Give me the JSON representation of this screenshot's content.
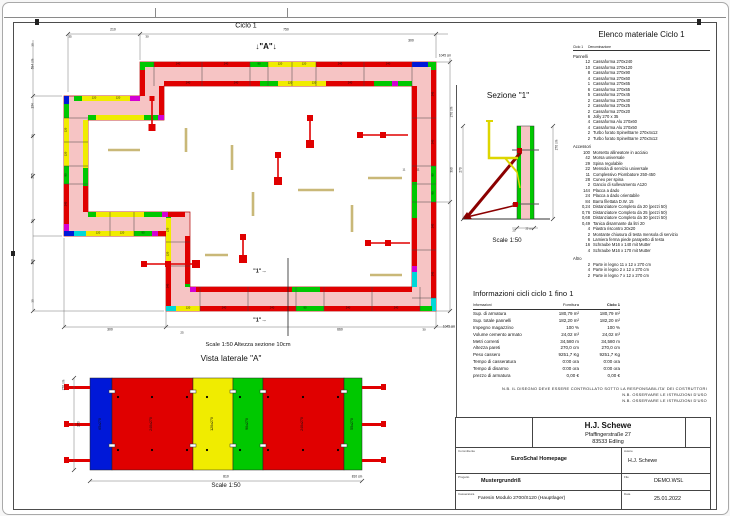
{
  "plan": {
    "labels": [
      {
        "t": "Ciclo 1",
        "x": 246,
        "y": 26,
        "s": 7
      },
      {
        "t": "↓\"A\"↓",
        "x": 266,
        "y": 47,
        "s": 8,
        "b": 1
      },
      {
        "t": "210",
        "x": 113,
        "y": 30,
        "s": 3.4
      },
      {
        "t": "35",
        "x": 70,
        "y": 37,
        "s": 3
      },
      {
        "t": "30",
        "x": 147,
        "y": 37,
        "s": 3
      },
      {
        "t": "750",
        "x": 286,
        "y": 30,
        "s": 3.4
      },
      {
        "t": "300",
        "x": 411,
        "y": 41,
        "s": 3.4
      },
      {
        "t": "1045 cm",
        "x": 445,
        "y": 56,
        "s": 3.2
      },
      {
        "t": "30",
        "x": 33,
        "y": 45,
        "s": 3,
        "r": 1
      },
      {
        "t": "694 cm",
        "x": 33,
        "y": 64,
        "s": 3.2,
        "r": 1
      },
      {
        "t": "134",
        "x": 33,
        "y": 106,
        "s": 3.2,
        "r": 1
      },
      {
        "t": "30",
        "x": 33,
        "y": 136,
        "s": 3,
        "r": 1
      },
      {
        "t": "255",
        "x": 33,
        "y": 176,
        "s": 3.2,
        "r": 1
      },
      {
        "t": "20",
        "x": 33,
        "y": 221,
        "s": 3,
        "r": 1
      },
      {
        "t": "190",
        "x": 33,
        "y": 262,
        "s": 3.2,
        "r": 1
      },
      {
        "t": "30",
        "x": 33,
        "y": 301,
        "s": 3,
        "r": 1
      },
      {
        "t": "300",
        "x": 110,
        "y": 330,
        "s": 3.4
      },
      {
        "t": "25",
        "x": 182,
        "y": 333,
        "s": 3
      },
      {
        "t": "660",
        "x": 340,
        "y": 330,
        "s": 3.4
      },
      {
        "t": "30",
        "x": 424,
        "y": 330,
        "s": 3
      },
      {
        "t": "1045 cm",
        "x": 449,
        "y": 327,
        "s": 3.2
      },
      {
        "t": "270 cm",
        "x": 452,
        "y": 112,
        "s": 3.2,
        "r": 1
      },
      {
        "t": "390",
        "x": 452,
        "y": 170,
        "s": 3.2,
        "r": 1
      },
      {
        "t": "11",
        "x": 404,
        "y": 170,
        "s": 2.8
      },
      {
        "t": "11",
        "x": 418,
        "y": 170,
        "s": 2.8
      },
      {
        "t": "\"1\"→",
        "x": 260,
        "y": 272,
        "s": 5.5,
        "b": 1
      },
      {
        "t": "\"1\"→",
        "x": 260,
        "y": 321,
        "s": 5.5,
        "b": 1
      },
      {
        "t": "Scale 1:50   Altezza sezione 10cm",
        "x": 248,
        "y": 346,
        "s": 5.8
      },
      {
        "t": "240",
        "x": 178,
        "y": 64.5,
        "s": 2.7
      },
      {
        "t": "240",
        "x": 226,
        "y": 64.5,
        "s": 2.7
      },
      {
        "t": "90",
        "x": 259,
        "y": 64.5,
        "s": 2.7
      },
      {
        "t": "120",
        "x": 280,
        "y": 64.5,
        "s": 2.7
      },
      {
        "t": "120",
        "x": 304,
        "y": 64.5,
        "s": 2.7
      },
      {
        "t": "240",
        "x": 340,
        "y": 64.5,
        "s": 2.7
      },
      {
        "t": "240",
        "x": 388,
        "y": 64.5,
        "s": 2.7
      },
      {
        "t": "240",
        "x": 188,
        "y": 83.5,
        "s": 2.7
      },
      {
        "t": "240",
        "x": 236,
        "y": 83.5,
        "s": 2.7
      },
      {
        "t": "120",
        "x": 290,
        "y": 83.5,
        "s": 2.7
      },
      {
        "t": "120",
        "x": 314,
        "y": 83.5,
        "s": 2.7
      },
      {
        "t": "240",
        "x": 350,
        "y": 83.5,
        "s": 2.7
      },
      {
        "t": "240",
        "x": 433.5,
        "y": 94,
        "s": 2.7,
        "r": 1
      },
      {
        "t": "240",
        "x": 433.5,
        "y": 142,
        "s": 2.7,
        "r": 1
      },
      {
        "t": "90",
        "x": 433.5,
        "y": 175,
        "s": 2.7,
        "r": 1
      },
      {
        "t": "90",
        "x": 433.5,
        "y": 193,
        "s": 2.7,
        "r": 1
      },
      {
        "t": "240",
        "x": 433.5,
        "y": 226,
        "s": 2.7,
        "r": 1
      },
      {
        "t": "240",
        "x": 433.5,
        "y": 274,
        "s": 2.7,
        "r": 1
      },
      {
        "t": "120",
        "x": 188,
        "y": 308.5,
        "s": 2.7
      },
      {
        "t": "240",
        "x": 224,
        "y": 308.5,
        "s": 2.7
      },
      {
        "t": "240",
        "x": 272,
        "y": 308.5,
        "s": 2.7
      },
      {
        "t": "90",
        "x": 305,
        "y": 308.5,
        "s": 2.7
      },
      {
        "t": "240",
        "x": 348,
        "y": 308.5,
        "s": 2.7
      },
      {
        "t": "240",
        "x": 396,
        "y": 308.5,
        "s": 2.7
      },
      {
        "t": "120",
        "x": 66.5,
        "y": 130,
        "s": 2.7,
        "r": 1
      },
      {
        "t": "120",
        "x": 66.5,
        "y": 154,
        "s": 2.7,
        "r": 1
      },
      {
        "t": "90",
        "x": 66.5,
        "y": 175,
        "s": 2.7,
        "r": 1
      },
      {
        "t": "240",
        "x": 66.5,
        "y": 204,
        "s": 2.7,
        "r": 1
      },
      {
        "t": "120",
        "x": 98,
        "y": 233.5,
        "s": 2.7
      },
      {
        "t": "120",
        "x": 122,
        "y": 233.5,
        "s": 2.7
      },
      {
        "t": "90",
        "x": 143,
        "y": 233.5,
        "s": 2.7
      },
      {
        "t": "120",
        "x": 168.5,
        "y": 230,
        "s": 2.7,
        "r": 1
      },
      {
        "t": "120",
        "x": 168.5,
        "y": 254,
        "s": 2.7,
        "r": 1
      },
      {
        "t": "240",
        "x": 168.5,
        "y": 286,
        "s": 2.7,
        "r": 1
      },
      {
        "t": "120",
        "x": 94,
        "y": 98.5,
        "s": 2.7
      },
      {
        "t": "120",
        "x": 118,
        "y": 98.5,
        "s": 2.7
      }
    ]
  },
  "side_view": {
    "labels": [
      {
        "t": "Vista laterale \"A\"",
        "x": 231,
        "y": 359,
        "s": 8.2
      },
      {
        "t": "65x270",
        "x": 101,
        "y": 424,
        "s": 3.6,
        "r": 1
      },
      {
        "t": "240x270",
        "x": 152,
        "y": 424,
        "s": 3.6,
        "r": 1
      },
      {
        "t": "120x270",
        "x": 213,
        "y": 424,
        "s": 3.6,
        "r": 1
      },
      {
        "t": "90x270",
        "x": 248,
        "y": 424,
        "s": 3.6,
        "r": 1
      },
      {
        "t": "240x270",
        "x": 303,
        "y": 424,
        "s": 3.6,
        "r": 1
      },
      {
        "t": "55x270",
        "x": 353,
        "y": 424,
        "s": 3.6,
        "r": 1
      },
      {
        "t": "270 cm",
        "x": 64,
        "y": 385,
        "s": 3.2,
        "r": 1
      },
      {
        "t": "270",
        "x": 79,
        "y": 424,
        "s": 3.4,
        "r": 1
      },
      {
        "t": "810",
        "x": 226,
        "y": 477,
        "s": 3.4
      },
      {
        "t": "810 cm",
        "x": 357,
        "y": 477,
        "s": 3.2
      },
      {
        "t": "Scale 1:50",
        "x": 226,
        "y": 486,
        "s": 6.2
      }
    ]
  },
  "sezione": {
    "labels": [
      {
        "t": "Sezione \"1\"",
        "x": 508,
        "y": 96,
        "s": 8.2
      },
      {
        "t": "270 cm",
        "x": 557,
        "y": 145,
        "s": 3.2,
        "r": 1
      },
      {
        "t": "270",
        "x": 461,
        "y": 170,
        "s": 3.2,
        "r": 1
      },
      {
        "t": "25",
        "x": 514,
        "y": 232,
        "s": 2.6
      },
      {
        "t": "25 cm",
        "x": 529,
        "y": 230,
        "s": 2.6
      },
      {
        "t": "Scale 1:50",
        "x": 507,
        "y": 241,
        "s": 6.2
      }
    ]
  },
  "material_list": {
    "title": "Elenco materiale  Ciclo 1",
    "cols": [
      "Ciclo 1",
      "Denominazione"
    ],
    "groups": [
      {
        "name": "Pannelli",
        "items": [
          {
            "qty": "12",
            "name": "Cassaforma 270x240"
          },
          {
            "qty": "10",
            "name": "Cassaforma 270x120"
          },
          {
            "qty": "8",
            "name": "Cassaforma 270x90"
          },
          {
            "qty": "4",
            "name": "Cassaforma 270x60"
          },
          {
            "qty": "1",
            "name": "Cassaforma 270x65"
          },
          {
            "qty": "6",
            "name": "Cassaforma 270x55"
          },
          {
            "qty": "5",
            "name": "Cassaforma 270x45"
          },
          {
            "qty": "2",
            "name": "Cassaforma 270x40"
          },
          {
            "qty": "2",
            "name": "Cassaforma 270x25"
          },
          {
            "qty": "2",
            "name": "Cassaforma 270x20"
          },
          {
            "qty": "6",
            "name": "Jolly 270 x 35"
          },
          {
            "qty": "4",
            "name": "Cassaforma Alu 270x60"
          },
          {
            "qty": "4",
            "name": "Cassaforma Alu 270x50"
          },
          {
            "qty": "2",
            "name": "Turbo forato Spine/Barre 270x4x12"
          },
          {
            "qty": "2",
            "name": "Turbo forato Spine/Barre 270x3x12"
          }
        ]
      },
      {
        "name": "Accessori",
        "items": [
          {
            "qty": "100",
            "name": "Morsetto allineatore in acciaio"
          },
          {
            "qty": "42",
            "name": "Morsa universale"
          },
          {
            "qty": "29",
            "name": "Spina regolabile"
          },
          {
            "qty": "22",
            "name": "Mensola di servizio universale"
          },
          {
            "qty": "11",
            "name": "Complessivo Piombatore 250-450"
          },
          {
            "qty": "28",
            "name": "Cuneo per spina"
          },
          {
            "qty": "2",
            "name": "Gancio di sollevamento A120"
          },
          {
            "qty": "144",
            "name": "Placca a dado"
          },
          {
            "qty": "24",
            "name": "Placca a dado orientabile"
          },
          {
            "qty": "84",
            "name": "Barra filettata D.W. 15"
          },
          {
            "qty": "0,24",
            "name": "Distanziatore Completo da 20 (pezzi 50)"
          },
          {
            "qty": "0,76",
            "name": "Distanziatore Completo da 25 (pezzi 50)"
          },
          {
            "qty": "0,68",
            "name": "Distanziatore Completo da 30 (pezzi 50)"
          },
          {
            "qty": "0,49",
            "name": "Tanica disarmante da litri 20"
          },
          {
            "qty": "4",
            "name": "Piastra riscontro 20x20"
          },
          {
            "qty": "2",
            "name": "Montante chiusura di testa mensola di servizio"
          },
          {
            "qty": "6",
            "name": "Lamiera ferma piede parapetto di testa"
          },
          {
            "qty": "16",
            "name": "Schraube M16 x 140 mit Mutter"
          },
          {
            "qty": "4",
            "name": "Schraube M16 x 170 mit Mutter"
          }
        ]
      },
      {
        "name": "Altro",
        "items": [
          {
            "qty": "2",
            "name": "Parte in legno 11 x 12 x 270 cm"
          },
          {
            "qty": "4",
            "name": "Parte in legno 2 x 12 x 270 cm"
          },
          {
            "qty": "2",
            "name": "Parte in legno 7 x 12 x 270 cm"
          }
        ]
      }
    ]
  },
  "info_table": {
    "title": "Informazioni cicli  ciclo 1 fino 1",
    "headers": [
      "Informazioni",
      "Fornitura",
      "Ciclo 1"
    ],
    "rows": [
      [
        "Sup. di armatura",
        "180,79 m²",
        "180,79 m²"
      ],
      [
        "Sup. totale pannelli",
        "182,20 m²",
        "182,20 m²"
      ],
      [
        "Impegno magazzino",
        "100 %",
        "100 %"
      ],
      [
        "Volume cemento armato",
        "24,02 m³",
        "24,02 m³"
      ],
      [
        "Metri correnti",
        "34,580 m",
        "34,580 m"
      ],
      [
        "Altezza pareti",
        "270,0 cm",
        "270,0 cm"
      ],
      [
        "Peso cassero",
        "9251,7 Kg",
        "9251,7 Kg"
      ],
      [
        "Tempo di casseratura",
        "0:00 ora",
        "0:00 ora"
      ],
      [
        "Tempo di disarmo",
        "0:00 ora",
        "0:00 ora"
      ],
      [
        "prezzo di armatura",
        "0,00 €",
        "0,00 €"
      ]
    ]
  },
  "notes": {
    "line1": "N.B. IL DISEGNO DEVE ESSERE CONTROLLATO SOTTO LA RESPONSABILITA' DEI COSTRUTTORI",
    "line2": "N.B. OSSERVARE LE ISTRUZIONI D'USO",
    "line3": "N.B. OSSERVARE LE ISTRUZIONI D'USO"
  },
  "title_block": {
    "company": "H.J. Schewe",
    "street": "Pfaffingerstraße 27",
    "city": "83533 Edling",
    "committente_label": "Committente",
    "committente": "EuroSchal Homepage",
    "autore_label": "Autore",
    "autore": "H.J. Schewe",
    "progetto_label": "Progetto",
    "progetto": "Mustergrundriß",
    "file_label": "File",
    "file": "DEMO.WSL",
    "casseratura_label": "Casseratura",
    "casseratura": "Faresin Modulo 2700/S120 (Hauptlager)",
    "data_label": "Data",
    "data": "25.01.2022"
  },
  "colors": {
    "panel_red": "#e00000",
    "panel_yellow": "#f0ec00",
    "panel_green": "#00c800",
    "panel_blue": "#0018d8",
    "panel_cyan": "#00d8d8",
    "panel_magenta": "#d400d4",
    "concrete_pink": "#f6c4c4",
    "timber": "#c9b878",
    "brace_dark": "#8b0000"
  }
}
